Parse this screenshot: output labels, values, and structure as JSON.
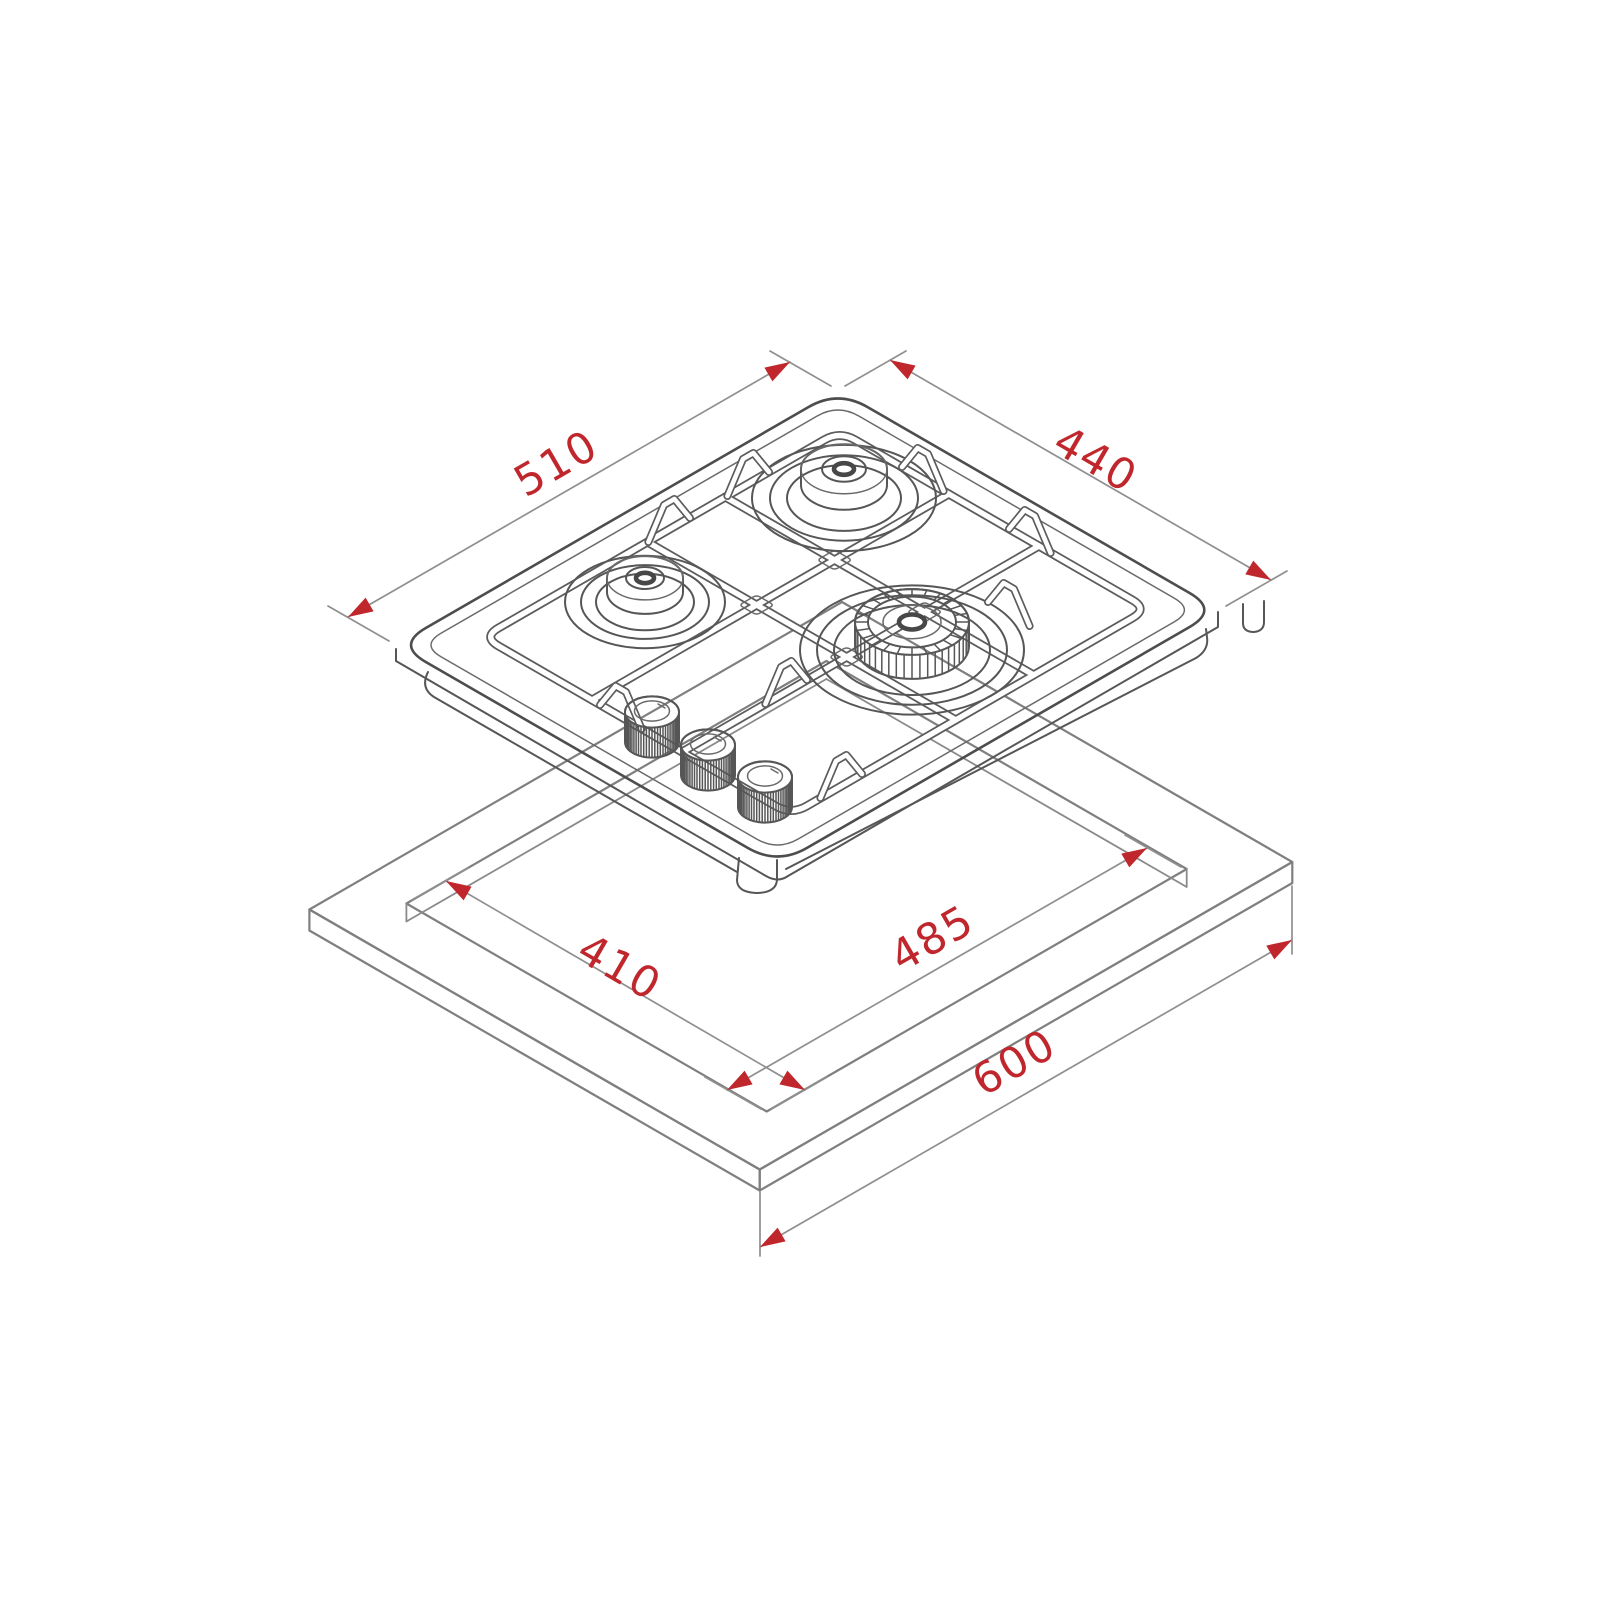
{
  "diagram": {
    "type": "isometric-installation-drawing",
    "subject": "built-in 3-burner gas hob shown above a worktop with rectangular cutout",
    "colors": {
      "accent": "#c0272d",
      "line": "#565656",
      "background": "#ffffff"
    },
    "dims": {
      "d510": {
        "label": "510",
        "measures": "hob width (top-left edge)"
      },
      "d440": {
        "label": "440",
        "measures": "hob depth (top-right edge)"
      },
      "d410": {
        "label": "410",
        "measures": "cutout depth (left edge)"
      },
      "d485": {
        "label": "485",
        "measures": "cutout width (right edge)"
      },
      "d600": {
        "label": "600",
        "measures": "worktop front edge"
      }
    }
  }
}
